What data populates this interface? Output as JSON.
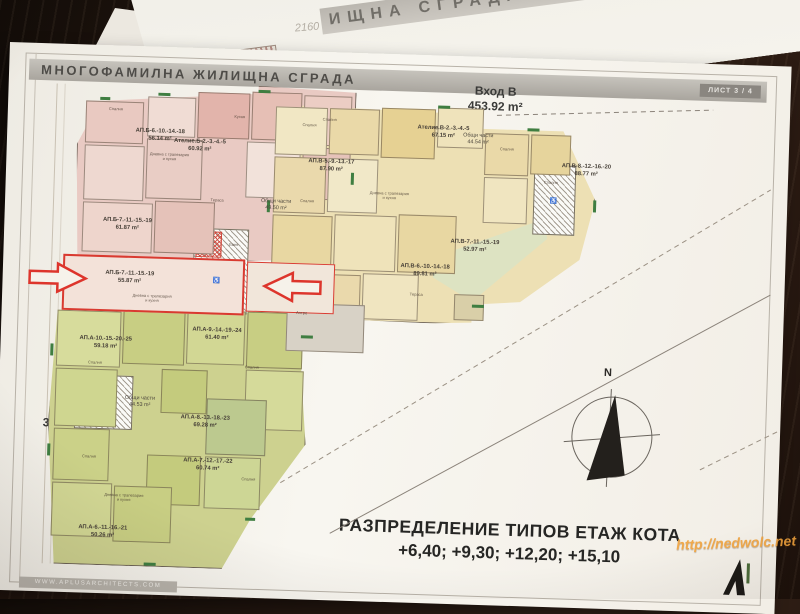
{
  "back_sheet": {
    "partial_title": "ИЩНА СГРАДА",
    "handwriting": "2160"
  },
  "sheet": {
    "title_banner": "МНОГОФАМИЛНА ЖИЛИЩНА СГРАДА",
    "sheet_tag": "ЛИСТ 3 / 4",
    "bottom_title_line1": "РАЗПРЕДЕЛЕНИЕ ТИПОВ ЕТАЖ КОТА",
    "bottom_title_line2": "+6,40; +9,30; +12,20; +15,10",
    "footer_url": "WWW.APLUSARCHITECTS.COM",
    "north_label": "N"
  },
  "watermark": {
    "text": "http://nedwolc.net",
    "color": "#f0a23c"
  },
  "entrances": [
    {
      "name": "Вход Б",
      "area": "420.69 m²"
    },
    {
      "name": "Вход В",
      "area": "453.92 m²"
    },
    {
      "name": "Вход А",
      "area": "376.48 m²"
    }
  ],
  "apartments": [
    {
      "id": "АП.Б-6.-10.-14.-18",
      "area": "56.14 m²"
    },
    {
      "id": "Ателие.Б-2.-3.-4.-5",
      "area": "60.92 m²"
    },
    {
      "id": "АП.Б-7.-11.-15.-19",
      "area": "61.87 m²"
    },
    {
      "id": "АП.Б-7.-11.-15.-19",
      "area": "55.87 m²",
      "highlighted": true
    },
    {
      "id": "АП.В-5.-9.-13.-17",
      "area": "87.90 m²"
    },
    {
      "id": "Ателие.В-2.-3.-4.-5",
      "area": "67.15 m²"
    },
    {
      "id": "АП.В-8.-12.-16.-20",
      "area": "88.77 m²"
    },
    {
      "id": "АП.В-6.-10.-14.-18",
      "area": "89.81 m²"
    },
    {
      "id": "АП.В-7.-11.-15.-19",
      "area": "52.97 m²"
    },
    {
      "id": "АП.А-10.-15.-20.-25",
      "area": "59.18 m²"
    },
    {
      "id": "АП.А-9.-14.-19.-24",
      "area": "61.40 m²"
    },
    {
      "id": "АП.А-8.-13.-18.-23",
      "area": "69.28 m²"
    },
    {
      "id": "АП.А-7.-12.-17.-22",
      "area": "60.74 m²"
    },
    {
      "id": "АП.А-6.-11.-16.-21",
      "area": "50.26 m²"
    }
  ],
  "common_areas": [
    {
      "label": "Общи части",
      "area": "49.50 m²"
    },
    {
      "label": "Общи части",
      "area": "44.54 m²"
    },
    {
      "label": "Общи части",
      "area": "44.53 m²"
    }
  ],
  "room_labels": [
    "Спалня",
    "Дневна с трапезария и кухня",
    "Кухня",
    "Баня",
    "Антре",
    "Тераса",
    "Килер"
  ],
  "icons": {
    "wheelchair": "♿"
  },
  "colors": {
    "highlight_red": "#d93a30",
    "wing_b_pink": "#e9cac3",
    "wing_v_yellow": "#ede0b4",
    "wing_a_green": "#cdd18f",
    "watermark_orange": "#f0a23c"
  }
}
